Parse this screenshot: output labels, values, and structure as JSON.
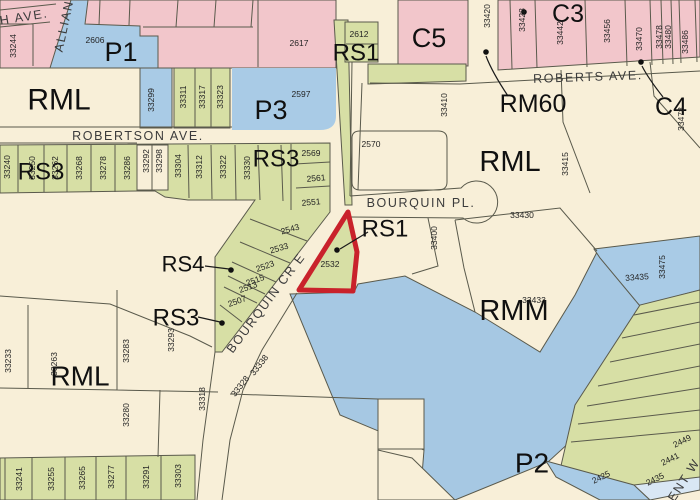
{
  "map": {
    "type": "zoning-parcel-map",
    "selected_parcel": "2532",
    "colors": {
      "commercial_pink": "#f2c6cb",
      "public_blue": "#a9cbe6",
      "residential_green": "#d7dfa5",
      "base_cream": "#f8efd8",
      "water_blue": "#a6c8e3",
      "light_blue_strip": "#d9e7f4",
      "highlight_red": "#c9222b",
      "line": "#5a5a4c"
    },
    "labels": [
      {
        "t": "P1",
        "x": 121,
        "y": 52,
        "k": "zone",
        "s": 27
      },
      {
        "t": "RML",
        "x": 59,
        "y": 100,
        "k": "zone",
        "s": 30
      },
      {
        "t": "RS3",
        "x": 41,
        "y": 172,
        "k": "zone",
        "s": 24
      },
      {
        "t": "P3",
        "x": 271,
        "y": 110,
        "k": "zone",
        "s": 27
      },
      {
        "t": "RS3",
        "x": 276,
        "y": 159,
        "k": "zone",
        "s": 24
      },
      {
        "t": "RS1",
        "x": 356,
        "y": 53,
        "k": "zone",
        "s": 24
      },
      {
        "t": "C5",
        "x": 429,
        "y": 38,
        "k": "zone",
        "s": 27
      },
      {
        "t": "C3",
        "x": 568,
        "y": 14,
        "k": "zone",
        "s": 25
      },
      {
        "t": "RM60",
        "x": 533,
        "y": 104,
        "k": "zone",
        "s": 25
      },
      {
        "t": "C4",
        "x": 671,
        "y": 107,
        "k": "zone",
        "s": 25
      },
      {
        "t": "RML",
        "x": 510,
        "y": 162,
        "k": "zone",
        "s": 29
      },
      {
        "t": "RS1",
        "x": 385,
        "y": 229,
        "k": "zone",
        "s": 24
      },
      {
        "t": "RS4",
        "x": 183,
        "y": 264,
        "k": "zone",
        "s": 22
      },
      {
        "t": "RS3",
        "x": 176,
        "y": 318,
        "k": "zone",
        "s": 24
      },
      {
        "t": "RMM",
        "x": 514,
        "y": 311,
        "k": "zone",
        "s": 29
      },
      {
        "t": "RML",
        "x": 80,
        "y": 376,
        "k": "zone",
        "s": 28
      },
      {
        "t": "P2",
        "x": 532,
        "y": 463,
        "k": "zone",
        "s": 28
      },
      {
        "t": "H AVE.",
        "x": 24,
        "y": 17,
        "k": "street",
        "r": -9
      },
      {
        "t": "ALLIAN",
        "x": 64,
        "y": 26,
        "k": "street",
        "r": -78
      },
      {
        "t": "ROBERTSON  AVE.",
        "x": 138,
        "y": 136,
        "k": "street"
      },
      {
        "t": "ROBERTS  AVE.",
        "x": 588,
        "y": 77,
        "k": "street",
        "r": -2
      },
      {
        "t": "BOURQUIN  PL.",
        "x": 421,
        "y": 203,
        "k": "street"
      },
      {
        "t": "BOURQUIN  CR  E",
        "x": 266,
        "y": 303,
        "k": "street",
        "r": -53
      },
      {
        "t": "ENT  W",
        "x": 684,
        "y": 480,
        "k": "street",
        "r": -57
      },
      {
        "t": "33244",
        "x": 13,
        "y": 46,
        "k": "parcel",
        "r": -90
      },
      {
        "t": "2606",
        "x": 95,
        "y": 40,
        "k": "parcel"
      },
      {
        "t": "2617",
        "x": 299,
        "y": 43,
        "k": "parcel"
      },
      {
        "t": "2612",
        "x": 359,
        "y": 34,
        "k": "parcel"
      },
      {
        "t": "2597",
        "x": 301,
        "y": 94,
        "k": "parcel"
      },
      {
        "t": "33299",
        "x": 151,
        "y": 100,
        "k": "parcel",
        "r": -90
      },
      {
        "t": "33311",
        "x": 183,
        "y": 97,
        "k": "parcel",
        "r": -90
      },
      {
        "t": "33317",
        "x": 202,
        "y": 97,
        "k": "parcel",
        "r": -90
      },
      {
        "t": "33323",
        "x": 220,
        "y": 97,
        "k": "parcel",
        "r": -90
      },
      {
        "t": "33420",
        "x": 487,
        "y": 16,
        "k": "parcel",
        "r": -90
      },
      {
        "t": "33428",
        "x": 522,
        "y": 20,
        "k": "parcel",
        "r": -90
      },
      {
        "t": "33442",
        "x": 560,
        "y": 33,
        "k": "parcel",
        "r": -90
      },
      {
        "t": "33456",
        "x": 607,
        "y": 31,
        "k": "parcel",
        "r": -90
      },
      {
        "t": "33470",
        "x": 639,
        "y": 39,
        "k": "parcel",
        "r": -90
      },
      {
        "t": "33478",
        "x": 659,
        "y": 37,
        "k": "parcel",
        "r": -90
      },
      {
        "t": "33480",
        "x": 668,
        "y": 37,
        "k": "parcel",
        "r": -90
      },
      {
        "t": "33486",
        "x": 685,
        "y": 42,
        "k": "parcel",
        "r": -90
      },
      {
        "t": "33478",
        "x": 681,
        "y": 119,
        "k": "parcel",
        "r": -90
      },
      {
        "t": "33410",
        "x": 444,
        "y": 105,
        "k": "parcel",
        "r": -90
      },
      {
        "t": "33415",
        "x": 565,
        "y": 164,
        "k": "parcel",
        "r": -90
      },
      {
        "t": "2570",
        "x": 371,
        "y": 144,
        "k": "parcel"
      },
      {
        "t": "33430",
        "x": 522,
        "y": 215,
        "k": "parcel"
      },
      {
        "t": "33400",
        "x": 434,
        "y": 238,
        "k": "parcel",
        "r": -90
      },
      {
        "t": "33433",
        "x": 534,
        "y": 300,
        "k": "parcel"
      },
      {
        "t": "33435",
        "x": 637,
        "y": 277,
        "k": "parcel",
        "r": -4
      },
      {
        "t": "33475",
        "x": 662,
        "y": 267,
        "k": "parcel",
        "r": -90
      },
      {
        "t": "33240",
        "x": 7,
        "y": 167,
        "k": "parcel",
        "r": -90
      },
      {
        "t": "33250",
        "x": 32,
        "y": 168,
        "k": "parcel",
        "r": -90
      },
      {
        "t": "33262",
        "x": 55,
        "y": 168,
        "k": "parcel",
        "r": -90
      },
      {
        "t": "33268",
        "x": 79,
        "y": 168,
        "k": "parcel",
        "r": -90
      },
      {
        "t": "33278",
        "x": 103,
        "y": 168,
        "k": "parcel",
        "r": -90
      },
      {
        "t": "33286",
        "x": 127,
        "y": 168,
        "k": "parcel",
        "r": -90
      },
      {
        "t": "33292",
        "x": 146,
        "y": 161,
        "k": "parcel",
        "r": -90
      },
      {
        "t": "33298",
        "x": 159,
        "y": 161,
        "k": "parcel",
        "r": -90
      },
      {
        "t": "33304",
        "x": 178,
        "y": 166,
        "k": "parcel",
        "r": -90
      },
      {
        "t": "33312",
        "x": 199,
        "y": 167,
        "k": "parcel",
        "r": -90
      },
      {
        "t": "33322",
        "x": 223,
        "y": 167,
        "k": "parcel",
        "r": -90
      },
      {
        "t": "33330",
        "x": 247,
        "y": 168,
        "k": "parcel",
        "r": -90
      },
      {
        "t": "2569",
        "x": 311,
        "y": 153,
        "k": "parcel"
      },
      {
        "t": "2561",
        "x": 316,
        "y": 178,
        "k": "parcel",
        "r": -5
      },
      {
        "t": "2551",
        "x": 311,
        "y": 202,
        "k": "parcel",
        "r": -5
      },
      {
        "t": "2543",
        "x": 290,
        "y": 229,
        "k": "parcel",
        "r": -16
      },
      {
        "t": "2533",
        "x": 279,
        "y": 248,
        "k": "parcel",
        "r": -16
      },
      {
        "t": "2523",
        "x": 265,
        "y": 266,
        "k": "parcel",
        "r": -20
      },
      {
        "t": "2515",
        "x": 255,
        "y": 280,
        "k": "parcel",
        "r": -20
      },
      {
        "t": "2513",
        "x": 248,
        "y": 287,
        "k": "parcel",
        "r": -20
      },
      {
        "t": "2507",
        "x": 237,
        "y": 301,
        "k": "parcel",
        "r": -20
      },
      {
        "t": "2532",
        "x": 330,
        "y": 264,
        "k": "parcel"
      },
      {
        "t": "33233",
        "x": 8,
        "y": 361,
        "k": "parcel",
        "r": -90
      },
      {
        "t": "33263",
        "x": 54,
        "y": 364,
        "k": "parcel",
        "r": -90
      },
      {
        "t": "33283",
        "x": 126,
        "y": 351,
        "k": "parcel",
        "r": -90
      },
      {
        "t": "33293",
        "x": 171,
        "y": 340,
        "k": "parcel",
        "r": -90
      },
      {
        "t": "33280",
        "x": 126,
        "y": 415,
        "k": "parcel",
        "r": -90
      },
      {
        "t": "33318",
        "x": 202,
        "y": 399,
        "k": "parcel",
        "r": -90
      },
      {
        "t": "33338",
        "x": 259,
        "y": 365,
        "k": "parcel",
        "r": -52
      },
      {
        "t": "33328",
        "x": 240,
        "y": 386,
        "k": "parcel",
        "r": -52
      },
      {
        "t": "33241",
        "x": 19,
        "y": 479,
        "k": "parcel",
        "r": -90
      },
      {
        "t": "33255",
        "x": 51,
        "y": 479,
        "k": "parcel",
        "r": -90
      },
      {
        "t": "33265",
        "x": 82,
        "y": 478,
        "k": "parcel",
        "r": -90
      },
      {
        "t": "33277",
        "x": 111,
        "y": 477,
        "k": "parcel",
        "r": -90
      },
      {
        "t": "33291",
        "x": 146,
        "y": 477,
        "k": "parcel",
        "r": -90
      },
      {
        "t": "33303",
        "x": 178,
        "y": 476,
        "k": "parcel",
        "r": -90
      },
      {
        "t": "2449",
        "x": 682,
        "y": 441,
        "k": "parcel",
        "r": -26
      },
      {
        "t": "2441",
        "x": 670,
        "y": 459,
        "k": "parcel",
        "r": -26
      },
      {
        "t": "2435",
        "x": 655,
        "y": 479,
        "k": "parcel",
        "r": -26
      },
      {
        "t": "2425",
        "x": 601,
        "y": 477,
        "k": "parcel",
        "r": -26
      }
    ]
  }
}
